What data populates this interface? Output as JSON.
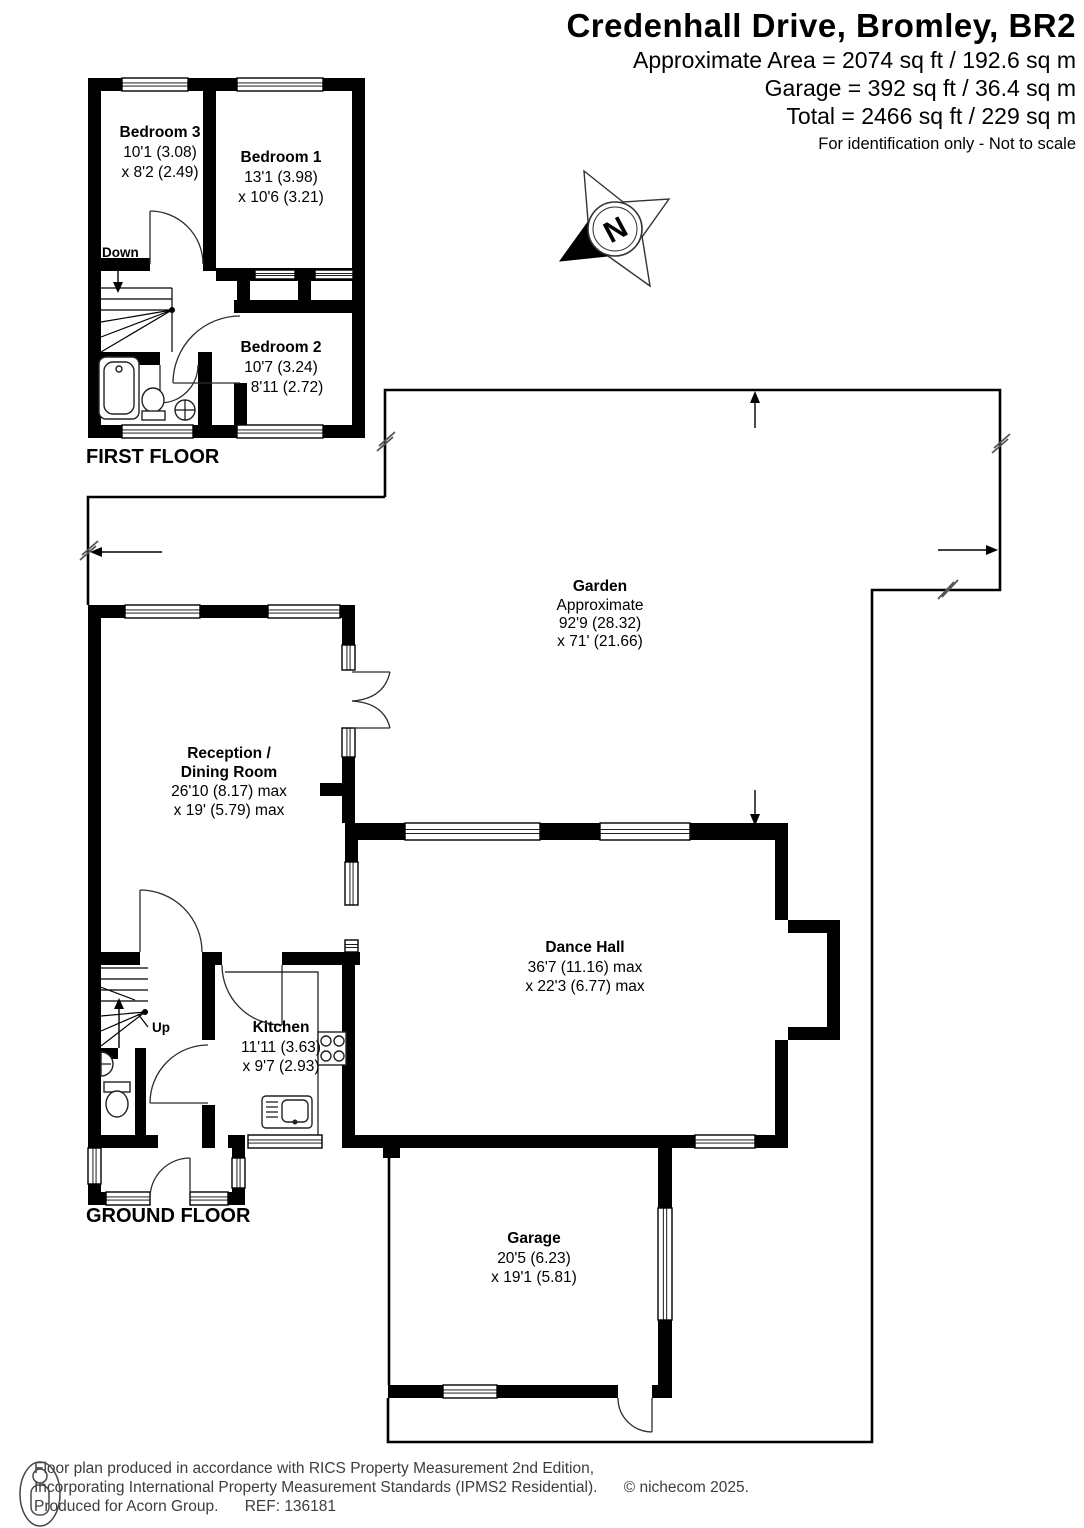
{
  "header": {
    "title": "Credenhall Drive, Bromley, BR2",
    "area_line": "Approximate Area = 2074 sq ft / 192.6 sq m",
    "garage_line": "Garage = 392 sq ft / 36.4 sq m",
    "total_line": "Total = 2466 sq ft / 229 sq m",
    "disclaimer": "For identification only - Not to scale"
  },
  "compass": {
    "letter": "N"
  },
  "floors": {
    "first": {
      "label": "FIRST FLOOR",
      "stairs_label": "Down",
      "rooms": {
        "bedroom3": {
          "name": "Bedroom 3",
          "dim1": "10'1 (3.08)",
          "dim2": "x 8'2 (2.49)"
        },
        "bedroom1": {
          "name": "Bedroom 1",
          "dim1": "13'1 (3.98)",
          "dim2": "x 10'6 (3.21)"
        },
        "bedroom2": {
          "name": "Bedroom 2",
          "dim1": "10'7 (3.24)",
          "dim2": "x 8'11 (2.72)"
        }
      }
    },
    "ground": {
      "label": "GROUND FLOOR",
      "stairs_label": "Up",
      "rooms": {
        "garden": {
          "name": "Garden",
          "sub": "Approximate",
          "dim1": "92'9 (28.32)",
          "dim2": "x 71' (21.66)"
        },
        "reception": {
          "name1": "Reception /",
          "name2": "Dining Room",
          "dim1": "26'10 (8.17) max",
          "dim2": "x 19' (5.79) max"
        },
        "dance_hall": {
          "name": "Dance Hall",
          "dim1": "36'7 (11.16) max",
          "dim2": "x 22'3 (6.77) max"
        },
        "kitchen": {
          "name": "Kitchen",
          "dim1": "11'11 (3.63)",
          "dim2": "x 9'7 (2.93)"
        },
        "garage": {
          "name": "Garage",
          "dim1": "20'5 (6.23)",
          "dim2": "x 19'1 (5.81)"
        }
      }
    }
  },
  "footer": {
    "line1": "Floor plan produced in accordance with RICS Property Measurement 2nd Edition,",
    "line2": "Incorporating International Property Measurement Standards (IPMS2 Residential).",
    "copyright": "© nichecom 2025.",
    "line3": "Produced for Acorn Group.",
    "ref": "REF:  136181"
  }
}
